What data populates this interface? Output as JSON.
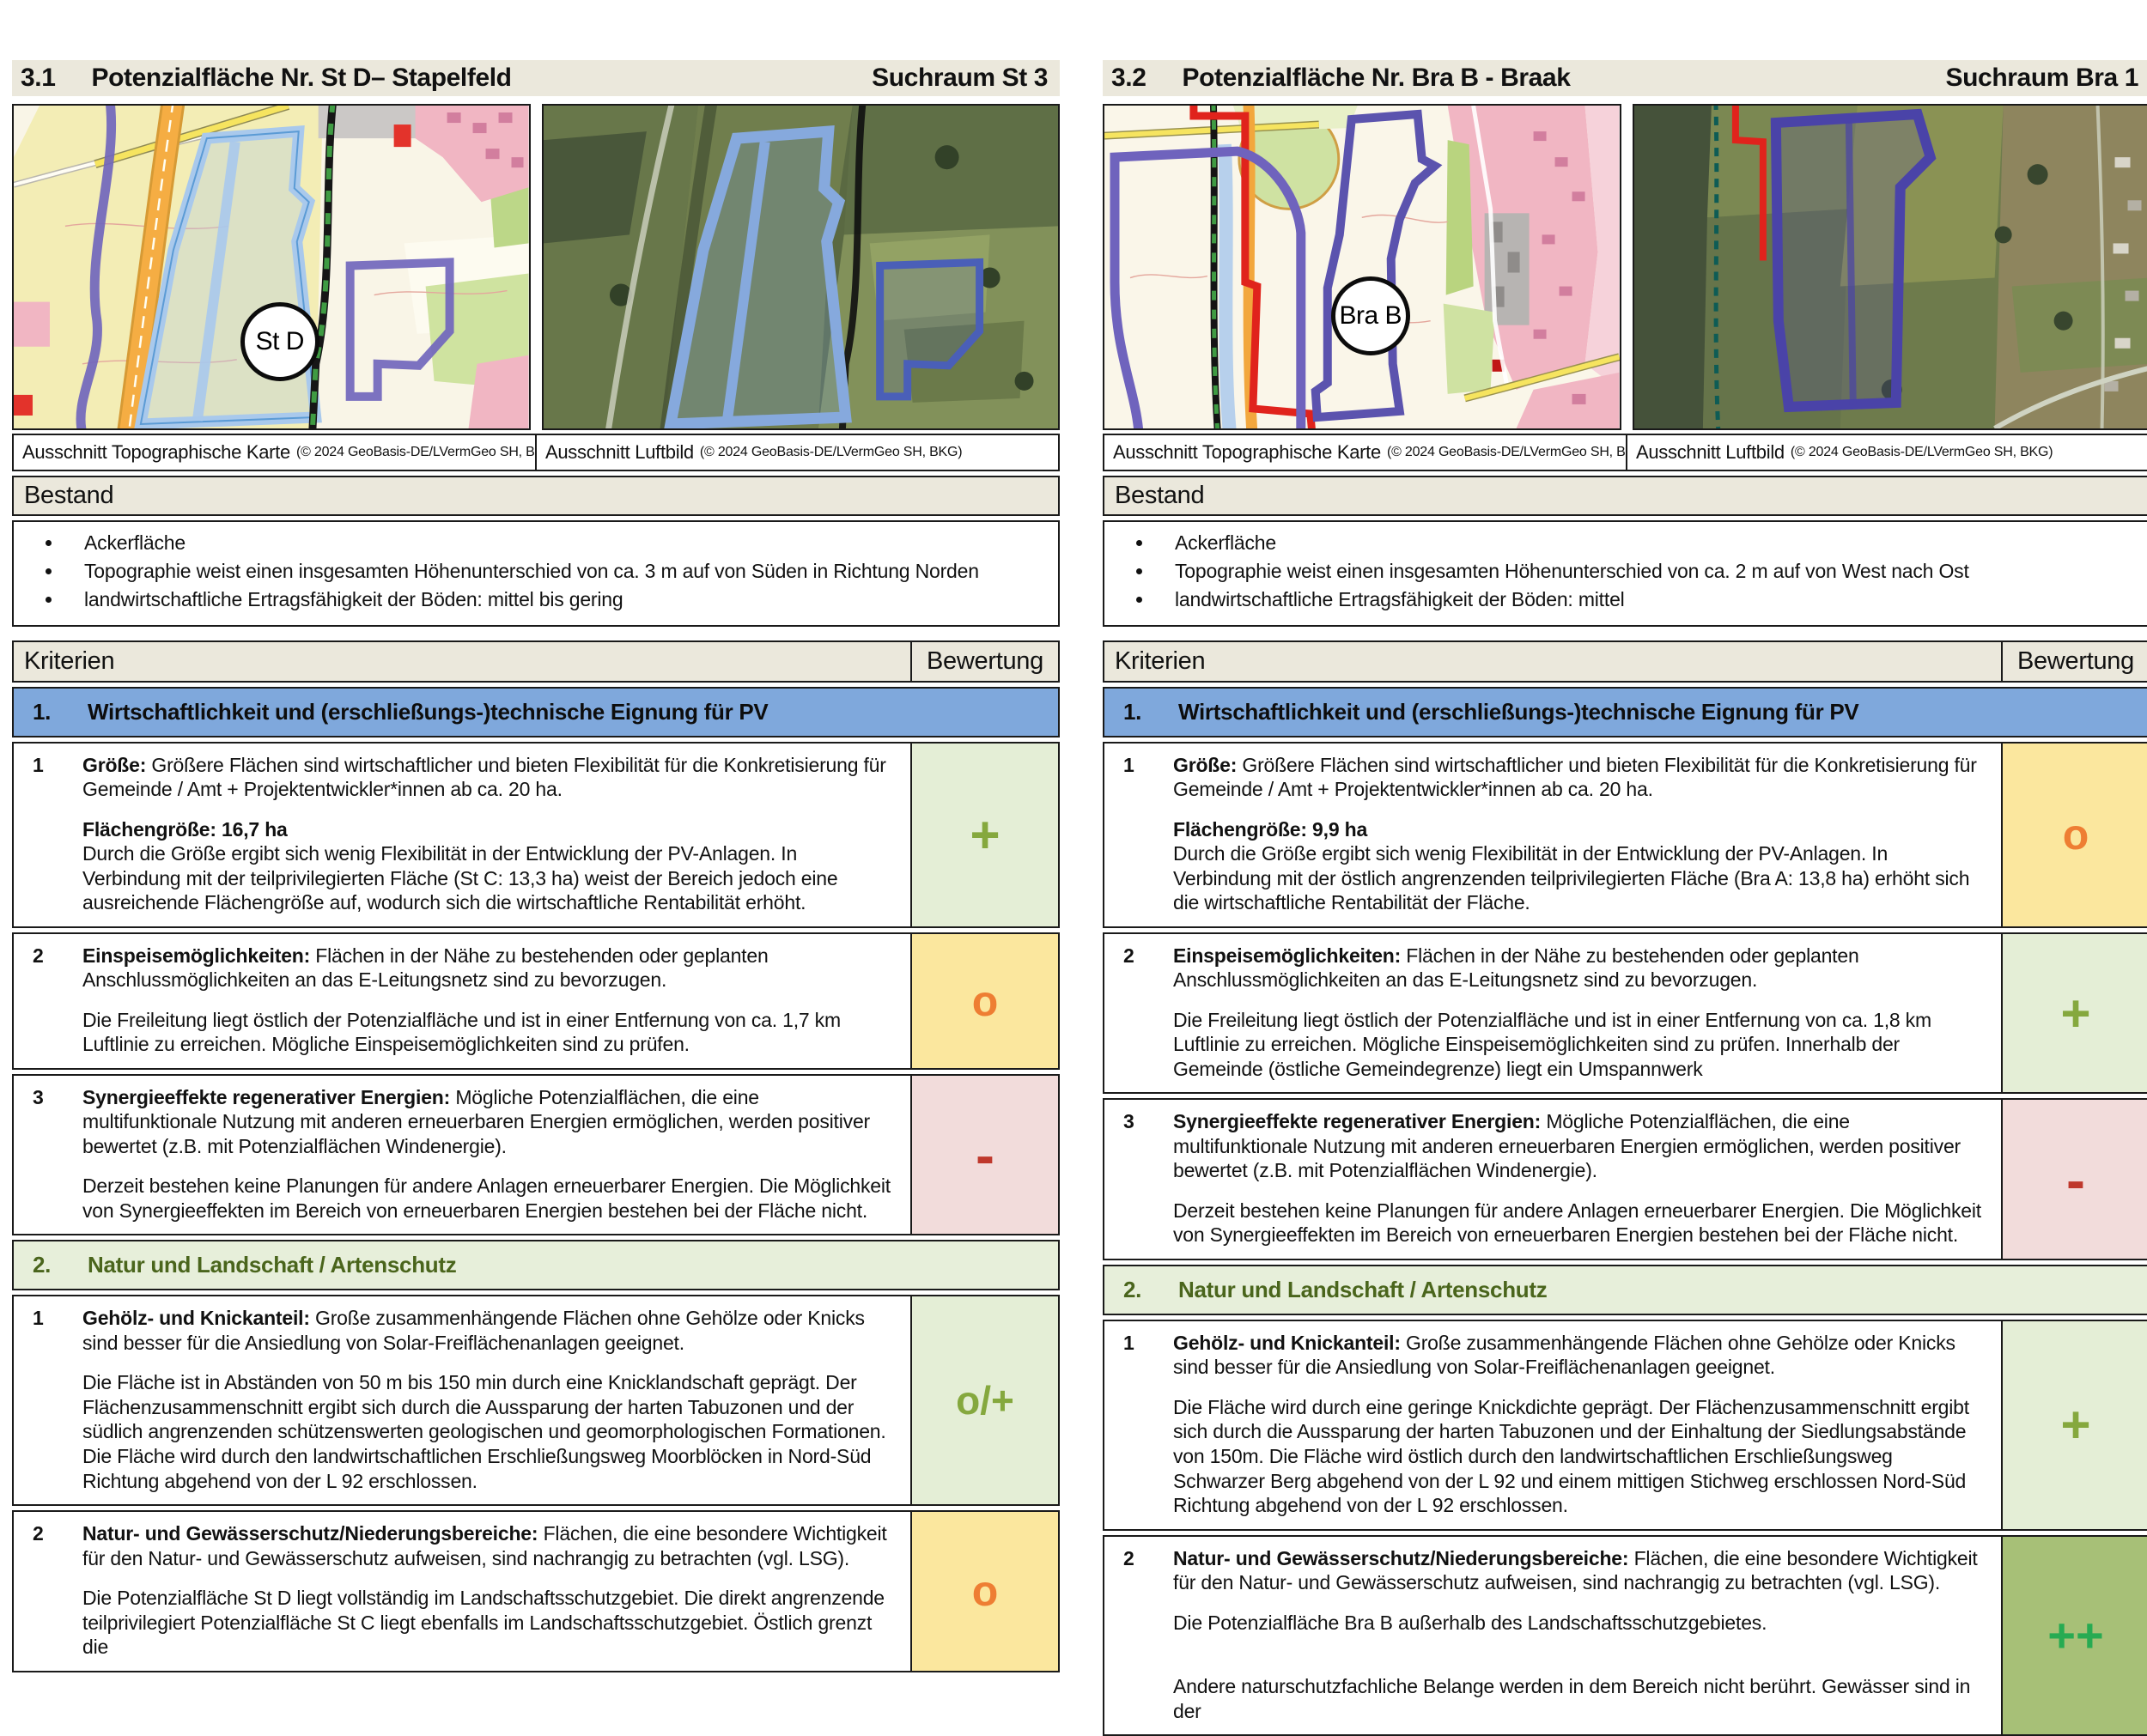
{
  "colors": {
    "header_bg": "#ebe8dc",
    "section1_bg": "#7fa8dc",
    "section2_bg": "#e7efda",
    "section2_text": "#4a651c",
    "rating_plus_bg": "#e4eed6",
    "rating_plus_text": "#85a83e",
    "rating_circle_bg": "#fbe79e",
    "rating_circle_text": "#ee7e33",
    "rating_minus_bg": "#f2dcdb",
    "rating_minus_text": "#bf382c",
    "rating_plusplus_bg": "#a7c077",
    "rating_plusplus_text": "#27ab52"
  },
  "panels": [
    {
      "section_number": "3.1",
      "title": "Potenzialfläche Nr. St D– Stapelfeld",
      "suchraum": "Suchraum St 3",
      "map_label": "St D",
      "topo_caption": "Ausschnitt Topographische Karte",
      "topo_credit": "(© 2024 GeoBasis-DE/LVermGeo SH, BKG)",
      "aerial_caption": "Ausschnitt Luftbild",
      "aerial_credit": "(© 2024 GeoBasis-DE/LVermGeo SH, BKG)",
      "bestand_title": "Bestand",
      "bestand_items": [
        "Ackerfläche",
        "Topographie weist einen insgesamten Höhenunterschied von ca. 3 m auf von Süden in Richtung Norden",
        "landwirtschaftliche Ertragsfähigkeit der Böden: mittel bis gering"
      ],
      "kriterien_label": "Kriterien",
      "bewertung_label": "Bewertung",
      "sections": [
        {
          "number": "1.",
          "title": "Wirtschaftlichkeit und (erschließungs-)technische Eignung für PV",
          "rows": [
            {
              "number": "1",
              "term": "Größe:",
              "desc": "Größere Flächen sind wirtschaftlicher und bieten Flexibilität für die Konkretisierung für Gemeinde / Amt + Projektentwickler*innen ab ca. 20 ha.",
              "bold_line": "Flächengröße: 16,7 ha",
              "body": "Durch die Größe ergibt sich wenig Flexibilität in der Entwicklung der PV-Anlagen. In Verbindung mit der teilprivilegierten Fläche (St C: 13,3 ha) weist der Bereich jedoch eine ausreichende Flächengröße auf, wodurch sich die wirtschaftliche Rentabilität erhöht.",
              "rating": "+",
              "rating_kind": "plus"
            },
            {
              "number": "2",
              "term": "Einspeisemöglichkeiten:",
              "desc": "Flächen in der Nähe zu bestehenden oder geplanten Anschlussmöglichkeiten an das E-Leitungsnetz sind zu bevorzugen.",
              "body": "Die Freileitung liegt östlich der Potenzialfläche und ist in einer Entfernung von ca. 1,7 km Luftlinie zu erreichen. Mögliche Einspeisemöglichkeiten sind zu prüfen.",
              "rating": "o",
              "rating_kind": "circle"
            },
            {
              "number": "3",
              "term": "Synergieeffekte regenerativer Energien:",
              "desc": "Mögliche Potenzialflächen, die eine multifunktionale Nutzung mit anderen erneuerbaren Energien ermöglichen, werden positiver bewertet (z.B. mit Potenzialflächen Windenergie).",
              "body": "Derzeit bestehen keine Planungen für andere Anlagen erneuerbarer Energien. Die Möglichkeit von Synergieeffekten im Bereich von erneuerbaren Energien bestehen bei der Fläche nicht.",
              "rating": "-",
              "rating_kind": "minus"
            }
          ]
        },
        {
          "number": "2.",
          "title": "Natur und Landschaft / Artenschutz",
          "rows": [
            {
              "number": "1",
              "term": "Gehölz- und Knickanteil:",
              "desc": "Große zusammenhängende Flächen ohne Gehölze oder Knicks sind besser für die Ansiedlung von Solar-Freiflächenanlagen geeignet.",
              "body": "Die Fläche ist in Abständen von 50 m bis 150 min durch eine Knicklandschaft geprägt. Der Flächenzusammenschnitt ergibt sich durch die Aussparung der harten Tabuzonen und der südlich angrenzenden schützenswerten geologischen und geomorphologischen Formationen. Die Fläche wird durch den landwirtschaftlichen Erschließungsweg Moorblöcken in Nord-Süd Richtung abgehend von der L 92 erschlossen.",
              "rating": "o/+",
              "rating_kind": "mixed"
            },
            {
              "number": "2",
              "term": "Natur- und Gewässerschutz/Niederungsbereiche:",
              "desc": "Flächen, die eine besondere Wichtigkeit für den Natur- und Gewässerschutz aufweisen, sind nachrangig zu betrachten (vgl. LSG).",
              "body": "Die Potenzialfläche St D liegt vollständig im Landschaftsschutzgebiet. Die direkt angrenzende teilprivilegiert Potenzialfläche St C liegt ebenfalls im Landschaftsschutzgebiet. Östlich grenzt die",
              "rating": "o",
              "rating_kind": "circle"
            }
          ]
        }
      ]
    },
    {
      "section_number": "3.2",
      "title": "Potenzialfläche Nr. Bra B - Braak",
      "suchraum": "Suchraum Bra 1",
      "map_label": "Bra B",
      "topo_caption": "Ausschnitt Topographische Karte",
      "topo_credit": "(© 2024 GeoBasis-DE/LVermGeo SH, BKG)",
      "aerial_caption": "Ausschnitt Luftbild",
      "aerial_credit": "(© 2024 GeoBasis-DE/LVermGeo SH, BKG)",
      "bestand_title": "Bestand",
      "bestand_items": [
        "Ackerfläche",
        "Topographie weist einen insgesamten Höhenunterschied von ca. 2 m auf von West nach Ost",
        "landwirtschaftliche Ertragsfähigkeit der Böden: mittel"
      ],
      "kriterien_label": "Kriterien",
      "bewertung_label": "Bewertung",
      "sections": [
        {
          "number": "1.",
          "title": "Wirtschaftlichkeit und (erschließungs-)technische Eignung für PV",
          "rows": [
            {
              "number": "1",
              "term": "Größe:",
              "desc": "Größere Flächen sind wirtschaftlicher und bieten Flexibilität für die Konkretisierung für Gemeinde / Amt + Projektentwickler*innen ab ca. 20 ha.",
              "bold_line": "Flächengröße: 9,9 ha",
              "body": "Durch die Größe ergibt sich wenig Flexibilität in der Entwicklung der PV-Anlagen. In Verbindung mit der östlich angrenzenden teilprivilegierten Fläche (Bra A: 13,8 ha) erhöht sich die wirtschaftliche Rentabilität der Fläche.",
              "rating": "o",
              "rating_kind": "circle"
            },
            {
              "number": "2",
              "term": "Einspeisemöglichkeiten:",
              "desc": "Flächen in der Nähe zu bestehenden oder geplanten Anschlussmöglichkeiten an das E-Leitungsnetz sind zu bevorzugen.",
              "body": "Die Freileitung liegt östlich der Potenzialfläche und ist in einer Entfernung von ca. 1,8 km Luftlinie zu erreichen. Mögliche Einspeisemöglichkeiten sind zu prüfen. Innerhalb der Gemeinde (östliche Gemeindegrenze) liegt ein Umspannwerk",
              "rating": "+",
              "rating_kind": "plus"
            },
            {
              "number": "3",
              "term": "Synergieeffekte regenerativer Energien:",
              "desc": "Mögliche Potenzialflächen, die eine multifunktionale Nutzung mit anderen erneuerbaren Energien ermöglichen, werden positiver bewertet (z.B. mit Potenzialflächen Windenergie).",
              "body": "Derzeit bestehen keine Planungen für andere Anlagen erneuerbarer Energien. Die Möglichkeit von Synergieeffekten im Bereich von erneuerbaren Energien bestehen bei der Fläche nicht.",
              "rating": "-",
              "rating_kind": "minus"
            }
          ]
        },
        {
          "number": "2.",
          "title": "Natur und Landschaft / Artenschutz",
          "rows": [
            {
              "number": "1",
              "term": "Gehölz- und Knickanteil:",
              "desc": "Große zusammenhängende Flächen ohne Gehölze oder Knicks sind besser für die Ansiedlung von Solar-Freiflächenanlagen geeignet.",
              "body": "Die Fläche wird durch eine geringe Knickdichte geprägt. Der Flächenzusammenschnitt ergibt sich durch die Aussparung der harten Tabuzonen und der Einhaltung der Siedlungsabstände von 150m. Die Fläche wird östlich durch den landwirtschaftlichen Erschließungsweg Schwarzer Berg abgehend von der L 92 und einem mittigen Stichweg erschlossen Nord-Süd Richtung abgehend von der L 92 erschlossen.",
              "rating": "+",
              "rating_kind": "plus"
            },
            {
              "number": "2",
              "term": "Natur- und Gewässerschutz/Niederungsbereiche:",
              "desc": "Flächen, die eine besondere Wichtigkeit für den Natur- und Gewässerschutz aufweisen, sind nachrangig zu betrachten (vgl. LSG).",
              "body": "Die Potenzialfläche Bra B außerhalb des Landschaftsschutzgebietes.",
              "body2": "Andere naturschutzfachliche Belange werden in dem Bereich nicht berührt. Gewässer sind in der",
              "rating": "++",
              "rating_kind": "plusplus"
            }
          ]
        }
      ]
    }
  ]
}
